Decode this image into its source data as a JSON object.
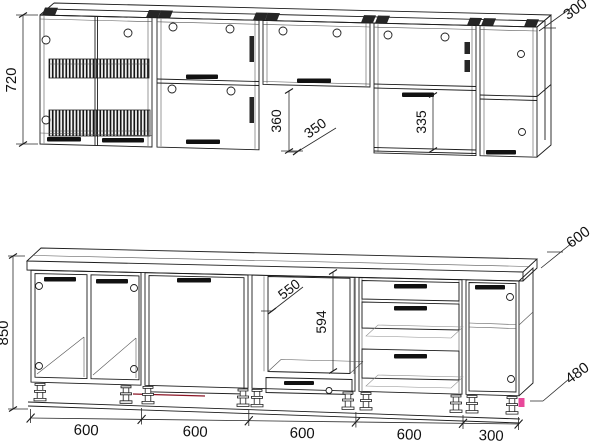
{
  "drawing": {
    "kind": "kitchen-cabinet-technical-drawing",
    "wall_view": {
      "height": "720",
      "depth": "300",
      "flip_cabinet_height": "360",
      "flip_cabinet_depth": "350",
      "open_section_height": "335"
    },
    "base_view": {
      "height": "850",
      "oven_opening_width": "550",
      "oven_opening_height": "594",
      "countertop_depth": "600",
      "plinth_depth": "480",
      "base_widths": [
        "600",
        "600",
        "600",
        "600",
        "300"
      ]
    },
    "colors": {
      "line": "#1c1c1c",
      "accent_pink": "#e8489a",
      "accent_red": "#8b1525"
    }
  }
}
